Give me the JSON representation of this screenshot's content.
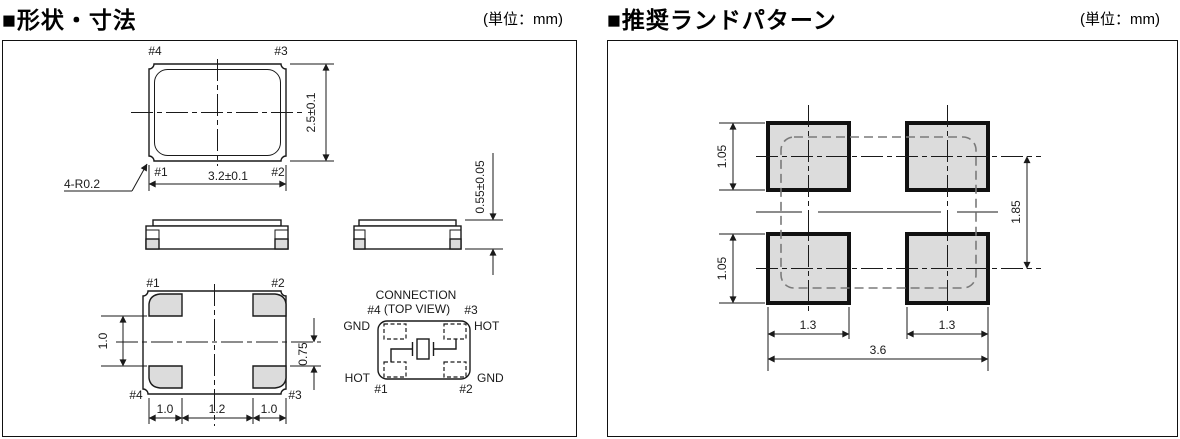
{
  "left": {
    "title": "■形状・寸法",
    "unit": "(単位：mm)",
    "top_view": {
      "pin4": "#4",
      "pin3": "#3",
      "pin1": "#1",
      "pin2": "#2",
      "dim_width": "3.2±0.1",
      "dim_height": "2.5±0.1",
      "corner_note": "4-R0.2"
    },
    "side_view": {
      "dim_height": "0.55±0.05"
    },
    "bottom_view": {
      "pin1": "#1",
      "pin2": "#2",
      "pin4": "#4",
      "pin3": "#3",
      "dim_left": "1.0",
      "dim_right": "0.75",
      "dim_b1": "1.0",
      "dim_b2": "1.2",
      "dim_b3": "1.0"
    },
    "connection": {
      "line1": "CONNECTION",
      "line2": "(TOP VIEW)",
      "pin4": "#4",
      "pin3": "#3",
      "pin1": "#1",
      "pin2": "#2",
      "gnd_tl": "GND",
      "hot_tr": "HOT",
      "hot_bl": "HOT",
      "gnd_br": "GND"
    }
  },
  "right": {
    "title": "■推奨ランドパターン",
    "unit": "(単位：mm)",
    "dims": {
      "pad_h_top": "1.05",
      "pad_h_bottom": "1.05",
      "pitch_v": "1.85",
      "pad_w_left": "1.3",
      "pad_w_right": "1.3",
      "overall_w": "3.6"
    }
  },
  "colors": {
    "pad_fill": "#dcdcdc",
    "line": "#1a1a1a",
    "dashed_outline": "#7a7a7a"
  }
}
